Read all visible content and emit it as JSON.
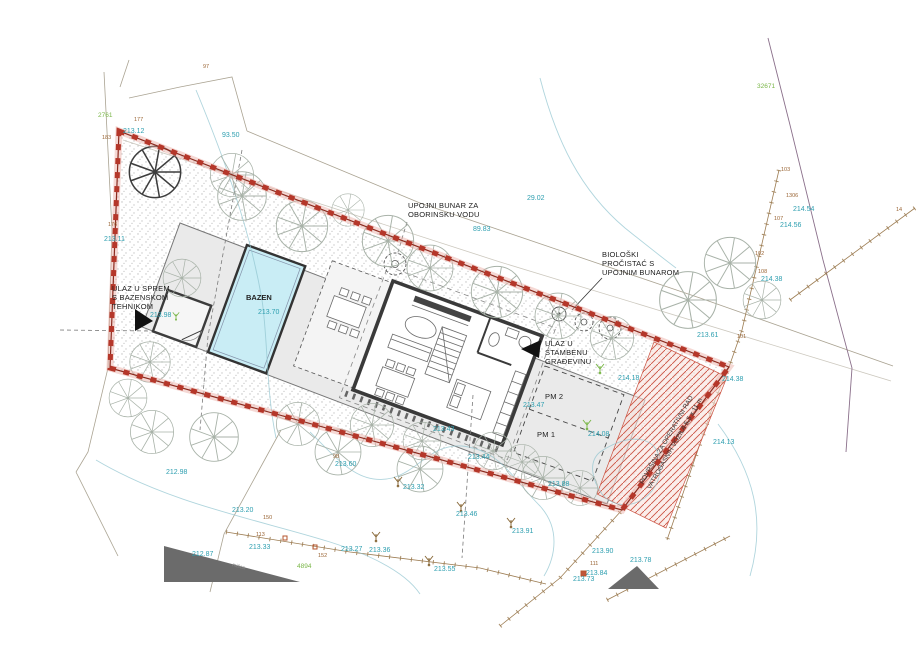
{
  "annotations": {
    "pool_room_entrance": {
      "lines": [
        "ULAZ U SPREM",
        "S BAZENSKOM",
        "TEHNIKOM"
      ]
    },
    "storm_well": {
      "lines": [
        "UPOJNI BUNAR ZA",
        "OBORINSKU VODU"
      ]
    },
    "bio_purifier": {
      "lines": [
        "BIOLOŠKI",
        "PROČISTAĆ S",
        "UPOJNIM BUNAROM"
      ]
    },
    "house_entrance": {
      "lines": [
        "ULAZ U",
        "STAMBENU",
        "GRAĐEVINU"
      ]
    },
    "fire_area": {
      "lines": [
        "POVRŠINA ZA OPERATIVNI RAD",
        "VATROGASNIH VOZILA 5,5 x 11 m"
      ]
    },
    "pool_label": "BAZEN",
    "parking_1": "PM 1",
    "parking_2": "PM 2",
    "street_label": "mišca"
  },
  "measurements": {
    "lengths": [
      {
        "x": 222,
        "y": 137,
        "v": "93.50"
      },
      {
        "x": 473,
        "y": 231,
        "v": "89.83"
      },
      {
        "x": 527,
        "y": 200,
        "v": "29.02"
      }
    ]
  },
  "elevations": [
    {
      "x": 104,
      "y": 241,
      "v": "213.11"
    },
    {
      "x": 123,
      "y": 133,
      "v": "213.12"
    },
    {
      "x": 258,
      "y": 314,
      "v": "213.70"
    },
    {
      "x": 150,
      "y": 317,
      "v": "213.98"
    },
    {
      "x": 697,
      "y": 337,
      "v": "213.61"
    },
    {
      "x": 618,
      "y": 380,
      "v": "214.18"
    },
    {
      "x": 588,
      "y": 436,
      "v": "214.08"
    },
    {
      "x": 433,
      "y": 431,
      "v": "213.43"
    },
    {
      "x": 468,
      "y": 459,
      "v": "213.44"
    },
    {
      "x": 523,
      "y": 407,
      "v": "213.47"
    },
    {
      "x": 335,
      "y": 466,
      "v": "213.60"
    },
    {
      "x": 403,
      "y": 489,
      "v": "213.32"
    },
    {
      "x": 166,
      "y": 474,
      "v": "212.98"
    },
    {
      "x": 232,
      "y": 512,
      "v": "213.20"
    },
    {
      "x": 249,
      "y": 549,
      "v": "213.33"
    },
    {
      "x": 192,
      "y": 556,
      "v": "212.87"
    },
    {
      "x": 341,
      "y": 551,
      "v": "213.27"
    },
    {
      "x": 369,
      "y": 552,
      "v": "213.36"
    },
    {
      "x": 434,
      "y": 571,
      "v": "213.55"
    },
    {
      "x": 456,
      "y": 516,
      "v": "213.46"
    },
    {
      "x": 512,
      "y": 533,
      "v": "213.91"
    },
    {
      "x": 548,
      "y": 486,
      "v": "213.88"
    },
    {
      "x": 592,
      "y": 553,
      "v": "213.90"
    },
    {
      "x": 630,
      "y": 562,
      "v": "213.78"
    },
    {
      "x": 586,
      "y": 575,
      "v": "213.84"
    },
    {
      "x": 573,
      "y": 581,
      "v": "213.73"
    },
    {
      "x": 793,
      "y": 211,
      "v": "214.54"
    },
    {
      "x": 780,
      "y": 227,
      "v": "214.56"
    },
    {
      "x": 761,
      "y": 281,
      "v": "214.38"
    },
    {
      "x": 722,
      "y": 381,
      "v": "214.38"
    },
    {
      "x": 713,
      "y": 444,
      "v": "214.13"
    }
  ],
  "survey_points": [
    {
      "x": 203,
      "y": 68,
      "v": "97"
    },
    {
      "x": 134,
      "y": 121,
      "v": "177"
    },
    {
      "x": 102,
      "y": 139,
      "v": "183"
    },
    {
      "x": 108,
      "y": 226,
      "v": "176"
    },
    {
      "x": 781,
      "y": 171,
      "v": "103"
    },
    {
      "x": 786,
      "y": 197,
      "v": "1306"
    },
    {
      "x": 774,
      "y": 220,
      "v": "107"
    },
    {
      "x": 755,
      "y": 255,
      "v": "102"
    },
    {
      "x": 758,
      "y": 273,
      "v": "108"
    },
    {
      "x": 737,
      "y": 338,
      "v": "101"
    },
    {
      "x": 896,
      "y": 211,
      "v": "14"
    },
    {
      "x": 263,
      "y": 519,
      "v": "150"
    },
    {
      "x": 256,
      "y": 536,
      "v": "113"
    },
    {
      "x": 318,
      "y": 557,
      "v": "152"
    },
    {
      "x": 590,
      "y": 565,
      "v": "111"
    },
    {
      "x": 333,
      "y": 458,
      "v": "98"
    }
  ],
  "parcel_numbers": [
    {
      "x": 757,
      "y": 88,
      "v": "32671"
    },
    {
      "x": 98,
      "y": 117,
      "v": "2761"
    },
    {
      "x": 297,
      "y": 568,
      "v": "4894"
    }
  ],
  "colors": {
    "boundary": "#b03024",
    "hatch": "#cc5544",
    "water": "#c9edf5",
    "contour": "#8fc3cf",
    "elevation_text": "#2e9fb0",
    "survey_text": "#9a6535",
    "parcel_text": "#7ab648",
    "platform": "#eaeaea"
  }
}
